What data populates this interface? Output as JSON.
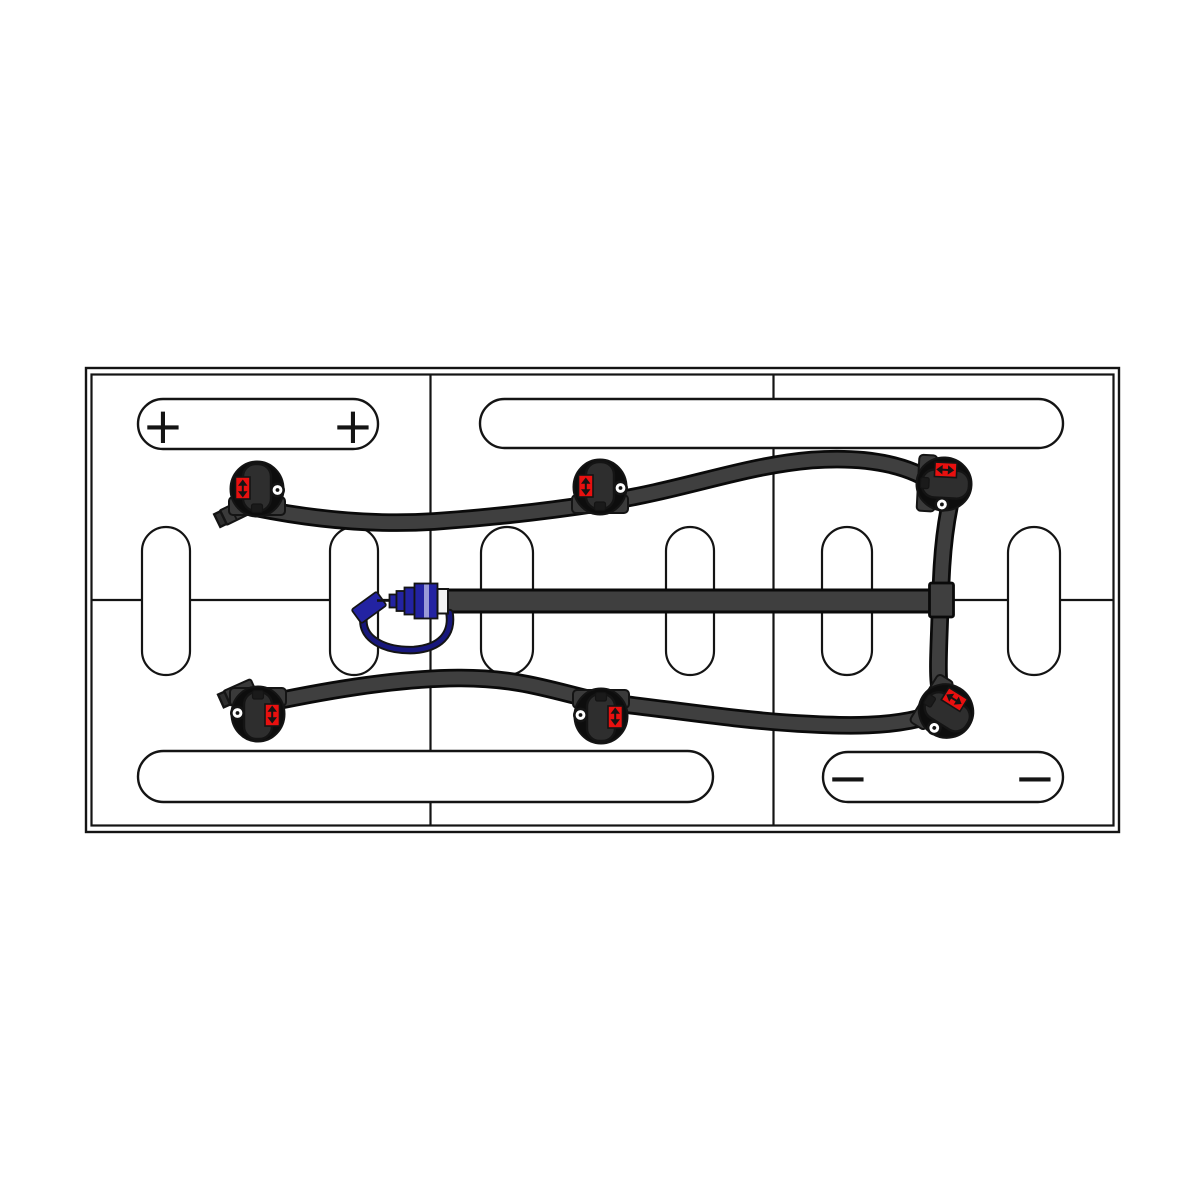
{
  "colors": {
    "paper": "#ffffff",
    "ink": "#141414",
    "tube": "#3f3f3f",
    "tube-edge": "#0a0a0a",
    "valve-head": "#0d0d0d",
    "valve-lever": "#2e2e2e",
    "valve-band": "#3a3a3a",
    "indicator-red": "#e8100f",
    "fitting-blue": "#2323a2",
    "fitting-blue-light": "#9a9ad8",
    "fitting-blue-dark": "#17177c"
  },
  "battery": {
    "grid": {
      "rows": 2,
      "columns": 3
    },
    "terminal_labels": {
      "positive": [
        "+",
        "+"
      ],
      "negative": [
        "−",
        "−"
      ]
    },
    "vent_slot_count": 6
  },
  "watering_system": {
    "valve_count": 6,
    "valves": [
      "top-left",
      "top-center",
      "top-right",
      "bottom-left",
      "bottom-center",
      "bottom-right"
    ],
    "fittings": [
      "quick-connect-coupler",
      "dust-cap",
      "tether-tube",
      "tee-fitting"
    ]
  }
}
